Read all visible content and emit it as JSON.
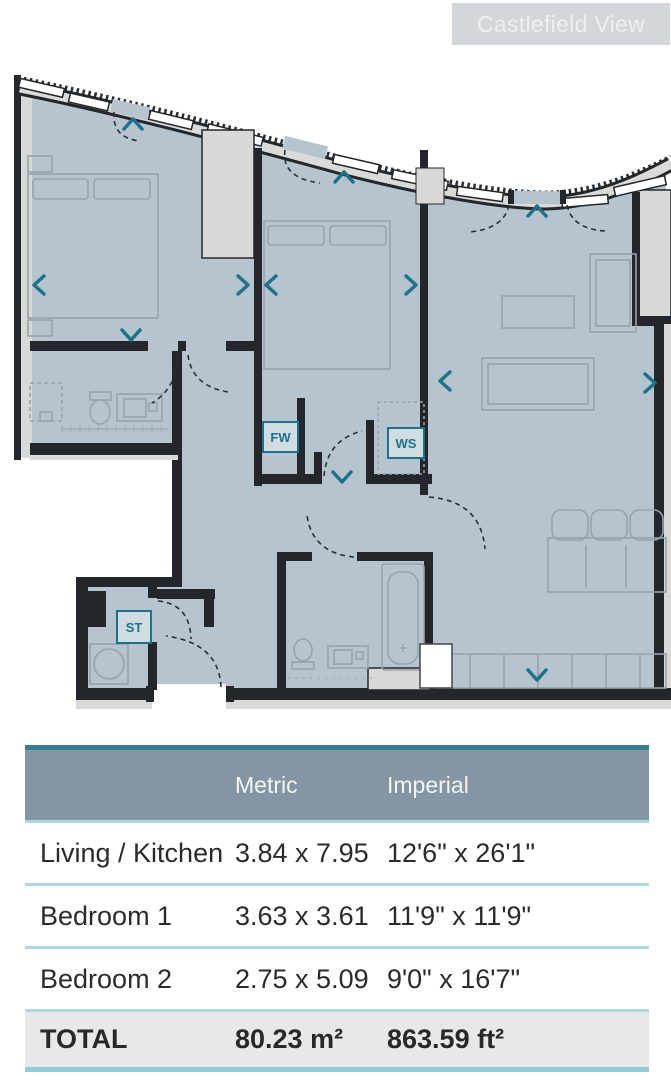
{
  "badge": {
    "label": "Castlefield View"
  },
  "floorplan": {
    "labels": {
      "fitted_wardrobe": "FW",
      "wardrobe_space": "WS",
      "storage": "ST"
    },
    "colors": {
      "floor": "#b5c4ce",
      "wall": "#23272b",
      "wall_fill": "#d8d9d7",
      "accent_teal": "#1f7188",
      "furniture": "#96a3ac"
    }
  },
  "table": {
    "header": {
      "name": "",
      "metric": "Metric",
      "imperial": "Imperial"
    },
    "rows": [
      {
        "name": "Living / Kitchen",
        "metric": "3.84 x 7.95",
        "imperial": "12'6\" x 26'1\""
      },
      {
        "name": "Bedroom 1",
        "metric": "3.63 x 3.61",
        "imperial": "11'9\" x 11'9\""
      },
      {
        "name": "Bedroom 2",
        "metric": "2.75 x 5.09",
        "imperial": "9'0\" x 16'7\""
      }
    ],
    "total": {
      "name": "TOTAL",
      "metric": "80.23 m²",
      "imperial": "863.59 ft²"
    }
  }
}
